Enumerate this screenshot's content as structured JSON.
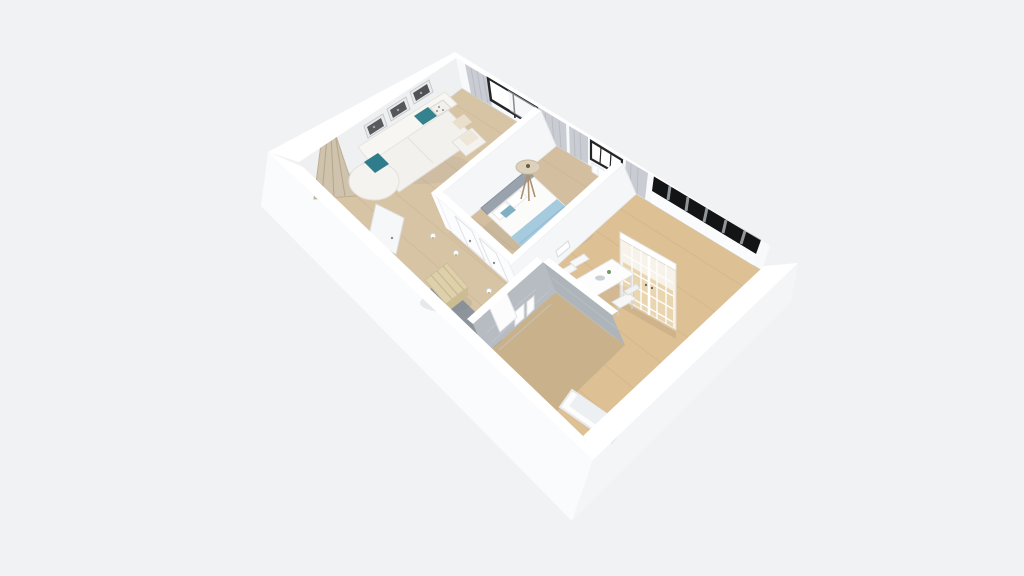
{
  "scene": {
    "type": "3d-floor-plan-render",
    "view": "top-down oblique axonometric",
    "background": "#f1f2f3",
    "rooms": [
      {
        "name": "living-room",
        "floor": "light oak wood",
        "items": [
          "white-l-shaped-sofa",
          "teal-accent-pillows",
          "three-framed-wall-prints",
          "decorative-branch-screen",
          "white-armchair",
          "white-side-table",
          "window-with-gray-curtains"
        ]
      },
      {
        "name": "bedroom",
        "floor": "light oak wood",
        "items": [
          "double-bed",
          "gray-upholstered-headboard",
          "light-blue-throw-blanket",
          "white-and-teal-pillows",
          "tripod-floor-lamp",
          "window-with-gray-curtains",
          "white-radiator",
          "small-wall-frame"
        ]
      },
      {
        "name": "kitchen-dining",
        "floor": "warm oak wood",
        "items": [
          "clerestory-ribbon-window",
          "glass-grid-cabinet",
          "white-dining-table",
          "white-chairs",
          "table-decor"
        ]
      },
      {
        "name": "hallway",
        "floor": "light oak wood",
        "items": [
          "slatted-wood-bench",
          "gray-accent-ledge",
          "potted-plant",
          "white-interior-doors",
          "wall-sconces",
          "entry-door"
        ]
      },
      {
        "name": "bathroom",
        "floor": "oak wood",
        "items": [
          "gray-stone-walls",
          "white-bathtub",
          "hanging-towels",
          "white-door"
        ]
      }
    ]
  },
  "palette": {
    "background": "#f1f2f3",
    "exterior_wall": "#fafbfc",
    "exterior_wall_shade": "#f4f5f7",
    "wall_top": "#ffffff",
    "wall_inner_nw": "#eef0f2",
    "wall_inner_ne": "#f8f9fa",
    "partition_wall": "#f5f6f8",
    "partition_wall_bright": "#fbfcfd",
    "floor_living": "#d7c4a5",
    "floor_bedroom": "#d3bf9f",
    "floor_kitchen": "#ddc094",
    "floor_bath": "#c9b28b",
    "plank_line": "#bfa886",
    "accent_teal": "#2f7d8c",
    "accent_teal_light": "#7fb0c4",
    "blanket_blue": "#a6cbdf",
    "headboard_gray": "#9aa3ad",
    "curtain_gray": "#c9ccd2",
    "window_frame_dark": "#232527",
    "ribbon_glass": "#131415",
    "bath_wall_gray": "#b6bcc1",
    "bath_wall_gray2": "#aeb5ba",
    "wood_bench": "#ddd0ab",
    "gray_ledge": "#8d949b",
    "plant_green": "#4d7c46",
    "cabinet_pane": "#e9d5ae",
    "lamp_shade": "#ded1bb",
    "sofa_white": "#f3f1ee",
    "bed_white": "#fbfbfa",
    "tub_white": "#fdfdfe",
    "branch_decor": "#cfc3ae"
  }
}
